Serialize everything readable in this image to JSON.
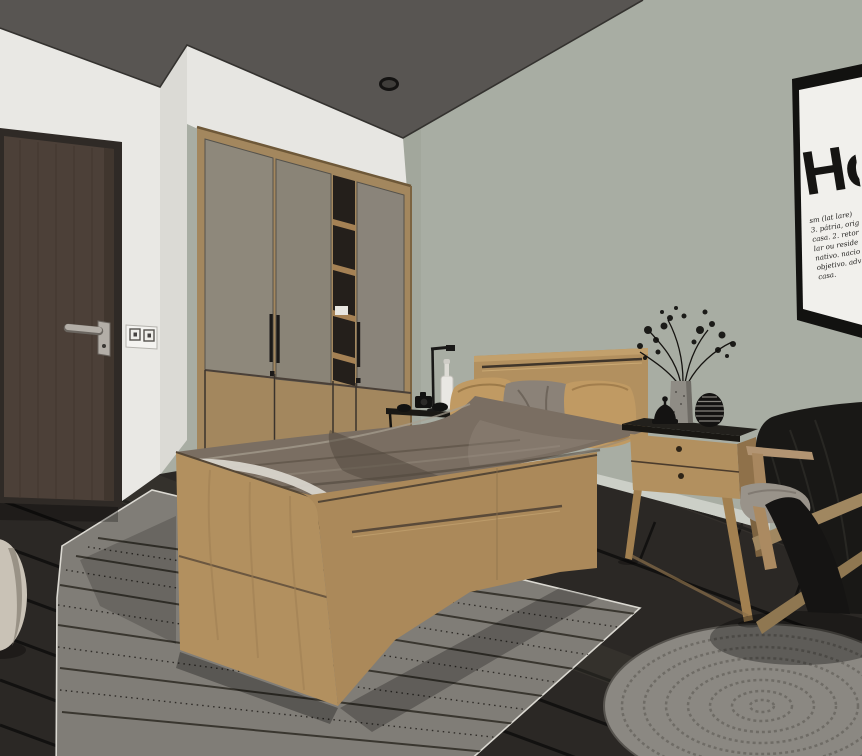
{
  "scene": {
    "label": "3D rendered bedroom interior"
  },
  "poster": {
    "title": "Ho",
    "definition_lines": [
      "sm (lat lare)",
      "3. pátria, orig",
      "casa. 2. retor",
      "lar ou reside",
      "nativo. nacio",
      "objetivo. adv",
      "casa."
    ]
  },
  "palette": {
    "ceiling": "#585552",
    "wall-left": "#e9e8e4",
    "wall-left-shade": "#dbdad5",
    "wall-right": "#a8ada3",
    "door": "#4c4038",
    "door-frame": "#2f2a26",
    "wardrobe-door": "#8e887b",
    "wood": "#b2905f",
    "wood-dark": "#8f714a",
    "wood-frame": "#a3875e",
    "duvet": "#7a6e62",
    "sheet": "#d8d4cb",
    "pillow-tan": "#c09a63",
    "pillow-gray": "#8b8278",
    "floor": "#2b2825",
    "rug": "#807d77",
    "round-rug": "#8b8882",
    "chair-blanket": "#191816",
    "cushion": "#99938a",
    "baseboard": "#cccfc7",
    "poster-bg": "#f1f0ec",
    "poster-ink": "#161513",
    "metal": "#b3aea7"
  }
}
